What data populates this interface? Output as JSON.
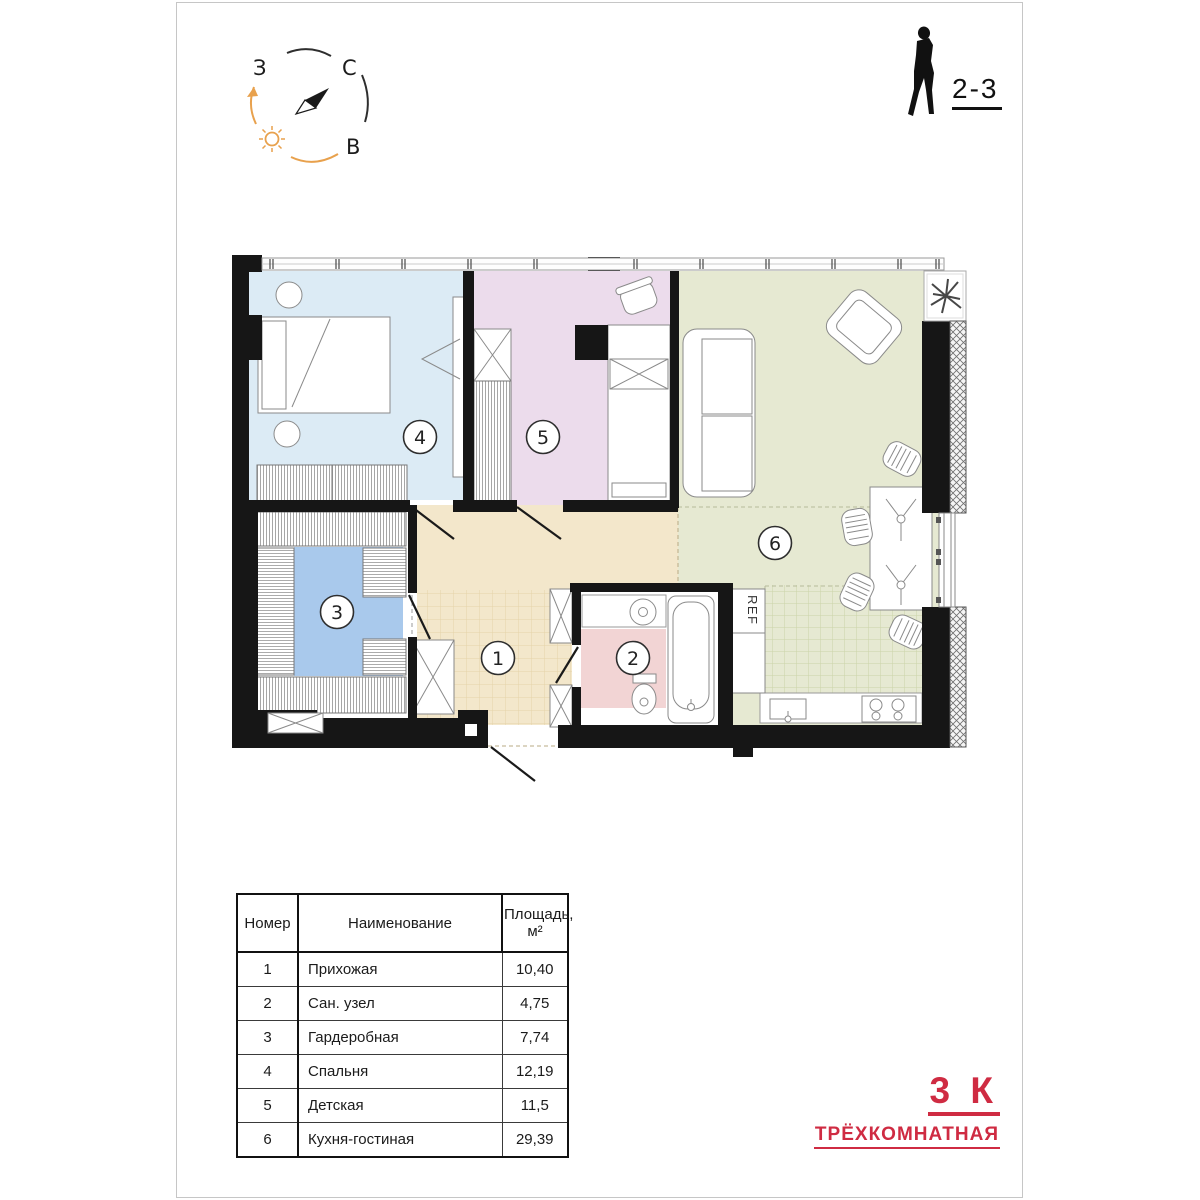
{
  "compass": {
    "west_label": "З",
    "north_label": "С",
    "east_label": "В",
    "accent_orange": "#e8a14d",
    "needle_color": "#1a1a1a"
  },
  "header": {
    "floors_label": "2-3"
  },
  "plan": {
    "ref_label": "REF",
    "wall_color": "#161616",
    "rooms": [
      {
        "num": "1",
        "name": "Прихожая",
        "area": "10,40",
        "color": "#f3e7cb"
      },
      {
        "num": "2",
        "name": "Сан. узел",
        "area": "4,75",
        "color": "#f2d4d4"
      },
      {
        "num": "3",
        "name": "Гардеробная",
        "area": "7,74",
        "color": "#a9c9ec"
      },
      {
        "num": "4",
        "name": "Спальня",
        "area": "12,19",
        "color": "#dcebf5"
      },
      {
        "num": "5",
        "name": "Детская",
        "area": "11,5",
        "color": "#ecdcec"
      },
      {
        "num": "6",
        "name": "Кухня-гостиная",
        "area": "29,39",
        "color": "#e6e9d2"
      }
    ]
  },
  "legend": {
    "col_num": "Номер",
    "col_name": "Наименование",
    "col_area_1": "Площадь,",
    "col_area_2": "м²"
  },
  "footer": {
    "type_short": "3 К",
    "type_full": "ТРЁХКОМНАТНАЯ",
    "accent_color": "#cf2b42"
  }
}
